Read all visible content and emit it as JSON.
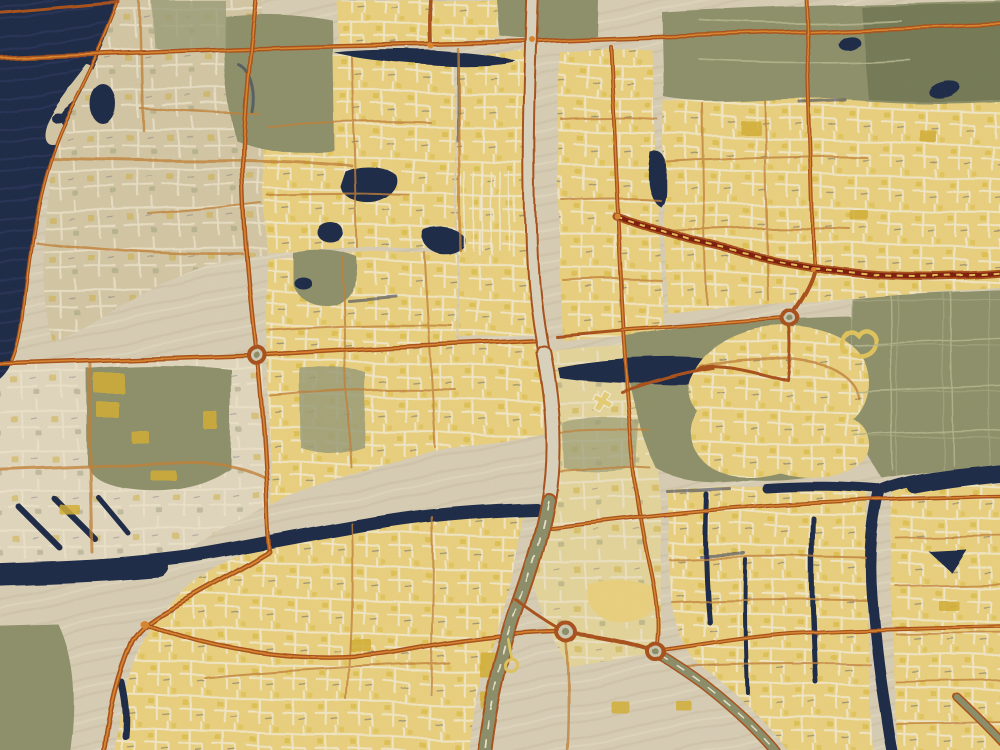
{
  "artwork": {
    "kind": "stylized city map, oil-painting effect",
    "visible_text": "none",
    "orientation": "sea in upper-left, desert in lower area"
  },
  "palette": {
    "bg": "#d7cdb5",
    "parchment": "#e0d6bd",
    "sand": "#d2c6a4",
    "yellow": "#e9d07e",
    "paleYellow": "#e3d49b",
    "gold": "#d2ae35",
    "cream": "#f1e9d0",
    "green": "#8d906a",
    "greenDark": "#747a56",
    "oliveSoft": "#9a9c78",
    "water": "#1f2947",
    "waterLight": "#32416e",
    "navyEdge": "#2b355c",
    "roadMain": "#a8511b",
    "roadCore": "#d8862e",
    "roadMinor": "#c08038",
    "roadDark": "#7e1c0c",
    "stripeGold": "#e4bd57",
    "highwayFill": "#d9d2bd",
    "oliveRoad": "#8b8e69",
    "ringFill": "#ccc7b1",
    "farmTrack": "#b3b48c",
    "loopYellow": "#e0c35c"
  },
  "features": [
    {
      "id": "sea",
      "kind": "water",
      "position": "top-left"
    },
    {
      "id": "sand-spit-with-lagoon",
      "kind": "coastline",
      "position": "top-left"
    },
    {
      "id": "coastal-district",
      "kind": "urban-sand",
      "position": "left"
    },
    {
      "id": "north-residential-blocks",
      "kind": "urban-yellow",
      "position": "top-center"
    },
    {
      "id": "northeast-residential-blocks",
      "kind": "urban-yellow",
      "position": "top-right"
    },
    {
      "id": "northeast-park",
      "kind": "green",
      "position": "top-right"
    },
    {
      "id": "central-residential-blocks",
      "kind": "urban-yellow",
      "position": "center"
    },
    {
      "id": "industrial-district",
      "kind": "urban-mixed",
      "position": "center-left"
    },
    {
      "id": "south-residential-blocks",
      "kind": "urban-yellow",
      "position": "bottom-center-left"
    },
    {
      "id": "southeast-grid-district",
      "kind": "urban-yellow",
      "position": "bottom-right"
    },
    {
      "id": "rounded-community-cluster",
      "kind": "urban-yellow",
      "position": "center-right"
    },
    {
      "id": "farm-fields",
      "kind": "green",
      "position": "right"
    },
    {
      "id": "desert-open-land",
      "kind": "empty",
      "position": "bottom-center"
    },
    {
      "id": "creek-canal",
      "kind": "water",
      "position": "bottom-left to center"
    },
    {
      "id": "east-canal",
      "kind": "water",
      "position": "right"
    },
    {
      "id": "center-pond",
      "kind": "water",
      "position": "center"
    },
    {
      "id": "central-highway",
      "kind": "road-major",
      "position": "vertical center"
    },
    {
      "id": "north-arterial",
      "kind": "road-major",
      "position": "horizontal top"
    },
    {
      "id": "mid-arterial",
      "kind": "road-major",
      "position": "horizontal middle"
    },
    {
      "id": "metro-line",
      "kind": "striped-rail",
      "position": "upper-right"
    },
    {
      "id": "roundabout-west",
      "kind": "junction"
    },
    {
      "id": "roundabout-interchange-1",
      "kind": "junction"
    },
    {
      "id": "roundabout-interchange-2",
      "kind": "junction"
    },
    {
      "id": "roundabout-northeast",
      "kind": "junction"
    }
  ]
}
